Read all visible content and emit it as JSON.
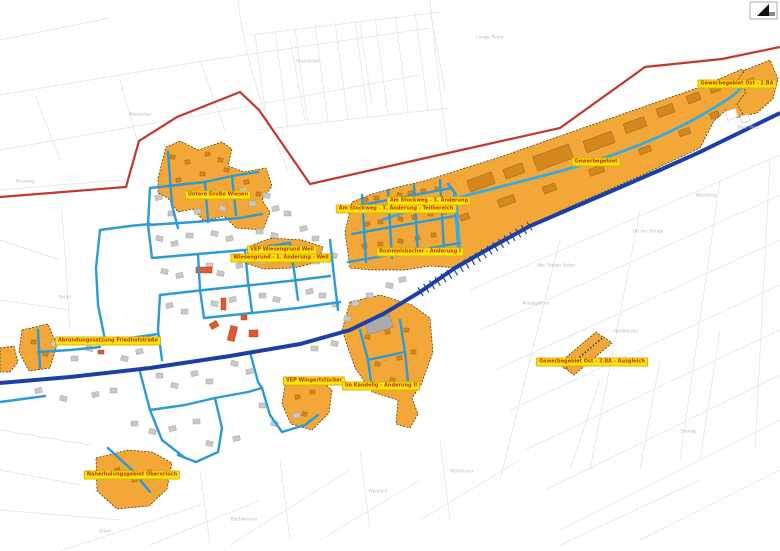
{
  "map": {
    "kind": "zoning-overview-plan",
    "north_arrow": "north-arrow"
  },
  "colors": {
    "background": "#ffffff",
    "zone_fill": "#f2a738",
    "zone_border": "#3a2b00",
    "zone_building": "#d4871e",
    "street_blue": "#2d9ad8",
    "main_road_blue": "#1a3fa8",
    "stream_blue": "#38a9e1",
    "boundary_red": "#c2372e",
    "parcel_line": "#e2e2e2",
    "building_gray": "#c9c9c9",
    "building_red": "#e2572e",
    "label_bg": "#ffe60a",
    "label_text": "#c22d00"
  },
  "plan_labels": [
    {
      "id": "gewerbegebiet-ost-2ba",
      "text": "Gewerbegebiet Ost - 2.BA",
      "x": 737,
      "y": 84
    },
    {
      "id": "gewerbegebiet",
      "text": "Gewerbegebiet",
      "x": 596,
      "y": 162
    },
    {
      "id": "am-stockweg-3-aenderung",
      "text": "Am Stockweg - 3. Änderung",
      "x": 429,
      "y": 201
    },
    {
      "id": "am-stockweg-3-aenderung-teilbereich",
      "text": "Am Stockweg - 3. Änderung - Teilbereich",
      "x": 396,
      "y": 209
    },
    {
      "id": "untere-grosse-wiesen",
      "text": "Untere Große Wiesen",
      "x": 218,
      "y": 195
    },
    {
      "id": "vep-wiesengrund-weil",
      "text": "VEP Wiesengrund Weil",
      "x": 282,
      "y": 250
    },
    {
      "id": "wiesengrund-1-aenderung-weil",
      "text": "Wiesengrund - 1. Änderung - Weil",
      "x": 281,
      "y": 258
    },
    {
      "id": "rommelsbacher-aenderung-1",
      "text": "Rommelsbacher - Änderung I",
      "x": 420,
      "y": 252
    },
    {
      "id": "abrundungssatzung-friedhofstrasse",
      "text": "Abrundungssatzung Friedhofstraße",
      "x": 108,
      "y": 341
    },
    {
      "id": "gewerbegebiet-ost-2ba-ausgleich",
      "text": "Gewerbegebiet Ost - 2.BA - Ausgleich",
      "x": 592,
      "y": 362
    },
    {
      "id": "vep-wingertstuecker",
      "text": "VEP Wingertstücker",
      "x": 314,
      "y": 381
    },
    {
      "id": "im-kandelig-aenderung-2",
      "text": "Im Kandelig - Änderung II",
      "x": 381,
      "y": 386
    },
    {
      "id": "naherholungsgebiet-obererloch",
      "text": "Naherholungsgebiet Obererloch",
      "x": 132,
      "y": 475
    }
  ],
  "field_labels": [
    {
      "text": "Wiesäcker",
      "x": 140,
      "y": 115
    },
    {
      "text": "Heuweg",
      "x": 25,
      "y": 182
    },
    {
      "text": "Brühl",
      "x": 65,
      "y": 298
    },
    {
      "text": "Steinäcker",
      "x": 308,
      "y": 62
    },
    {
      "text": "Lange Äcker",
      "x": 490,
      "y": 38
    },
    {
      "text": "Alte Steige Äcker",
      "x": 556,
      "y": 266
    },
    {
      "text": "Ob der Steige",
      "x": 648,
      "y": 232
    },
    {
      "text": "Weinberg",
      "x": 706,
      "y": 196
    },
    {
      "text": "Krautgärten",
      "x": 536,
      "y": 304
    },
    {
      "text": "Hanfländer",
      "x": 626,
      "y": 332
    },
    {
      "text": "Mühläcker",
      "x": 462,
      "y": 472
    },
    {
      "text": "Bachwiesen",
      "x": 244,
      "y": 520
    },
    {
      "text": "Steinig",
      "x": 688,
      "y": 432
    },
    {
      "text": "Weidach",
      "x": 378,
      "y": 492
    },
    {
      "text": "Alter Weg",
      "x": 748,
      "y": 128
    },
    {
      "text": "Erlen",
      "x": 105,
      "y": 532
    }
  ]
}
